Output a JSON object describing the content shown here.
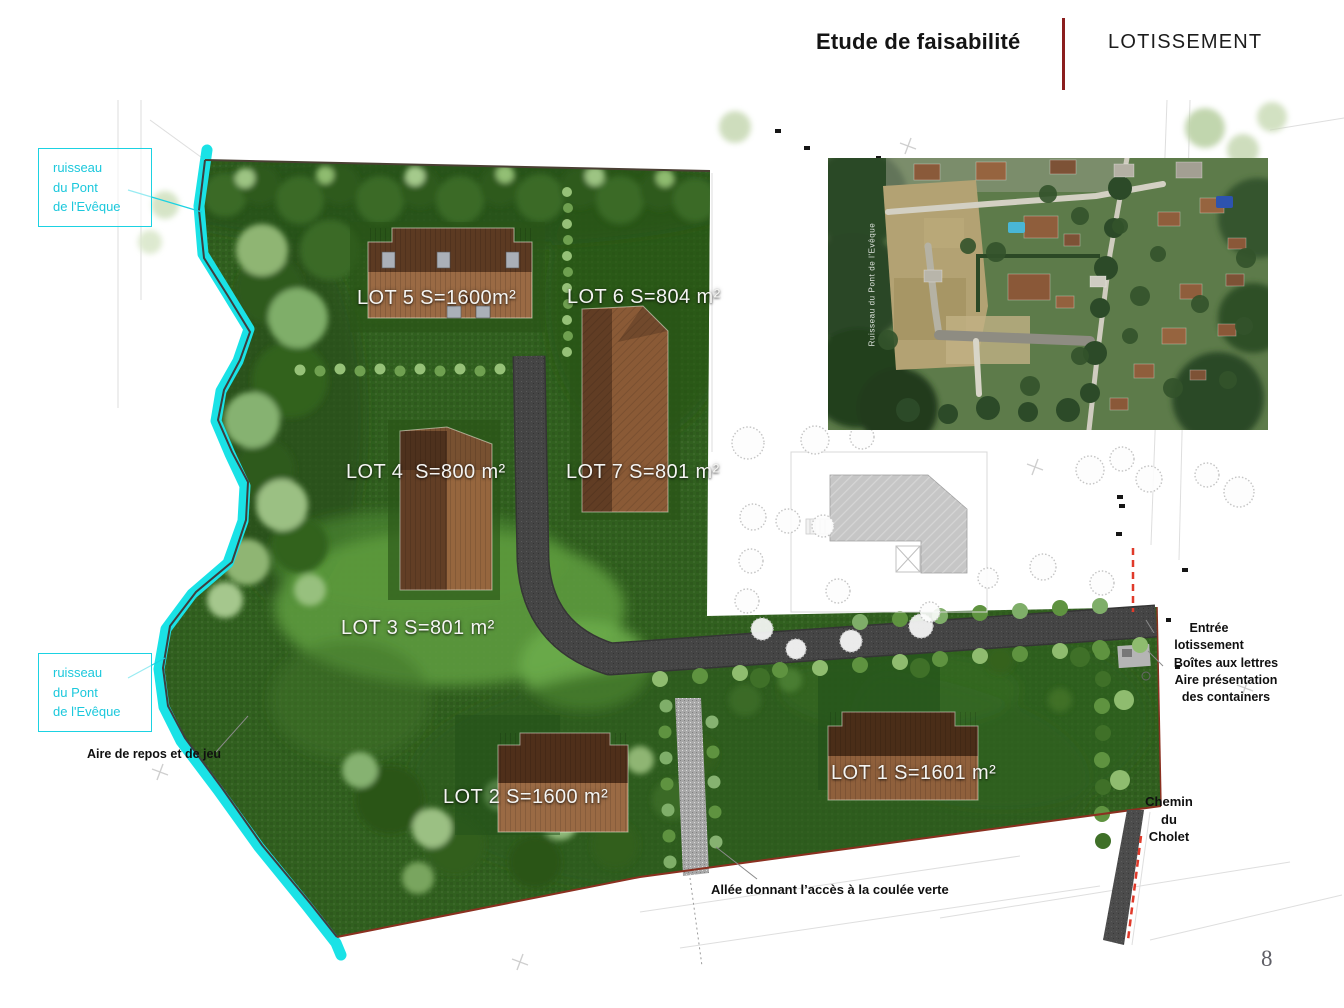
{
  "header": {
    "title": "Etude de faisabilité",
    "subtitle": "LOTISSEMENT",
    "divider_color": "#8b1e1e"
  },
  "page_number": "8",
  "plan": {
    "lots": [
      {
        "id": "lot-5",
        "label": "LOT 5 S=1600m²"
      },
      {
        "id": "lot-6",
        "label": "LOT 6 S=804 m²"
      },
      {
        "id": "lot-4",
        "label": "LOT 4  S=800 m²"
      },
      {
        "id": "lot-7",
        "label": "LOT 7 S=801 m²"
      },
      {
        "id": "lot-3",
        "label": "LOT 3 S=801 m²"
      },
      {
        "id": "lot-2",
        "label": "LOT 2 S=1600 m²"
      },
      {
        "id": "lot-1",
        "label": "LOT 1 S=1601 m²"
      }
    ],
    "stream_label": {
      "lines": [
        "ruisseau",
        "du Pont",
        "de l'Evêque"
      ]
    },
    "annotations": {
      "aire_repos": "Aire de repos et de jeu",
      "allee": "Allée donnant l’accès à la coulée verte",
      "entree": {
        "lines": [
          "Entrée",
          "lotissement"
        ]
      },
      "boites": {
        "lines": [
          "Boîtes aux lettres",
          "Aire présentation",
          "des containers"
        ]
      },
      "chemin": {
        "lines": [
          "Chemin",
          "du",
          "Cholet"
        ]
      }
    },
    "aerial_caption": "Ruisseau du Pont de l'Evêque",
    "colors": {
      "stream_cyan": "#1ae2e6",
      "site_green": "#31601f",
      "road_gray": "#424242",
      "roof_brown": "#8a5a36",
      "boundary_red": "#8b3020",
      "label_cyan": "#1bd2e2"
    }
  }
}
